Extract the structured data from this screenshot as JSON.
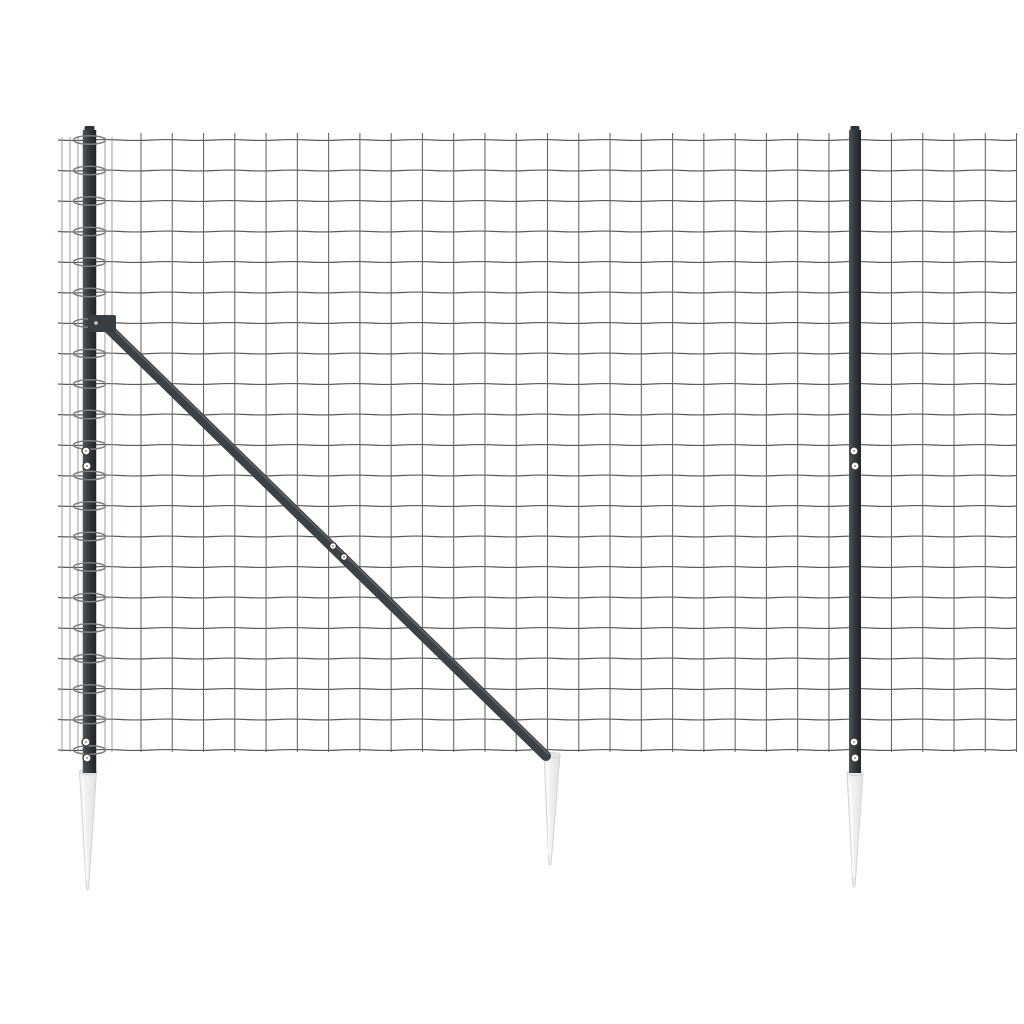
{
  "scene": {
    "description": "anthracite wire mesh fence panel with two posts, diagonal brace strut and three ground anchor spikes on white background",
    "background": "#ffffff",
    "width": 1024,
    "height": 1024,
    "colors": {
      "wire": "#565a5c",
      "wire_vertical": "#616466",
      "wire_edge": "#8f9294",
      "ring": "#7a7e80",
      "post_grad": [
        "#51575b",
        "#3a3f43",
        "#2c3134",
        "#202427"
      ],
      "post_cap": "#2e3236",
      "brace": "#3c4145",
      "brace_highlight": "#71777d",
      "clamp": "#393e42",
      "screw_fill": "#ffffff",
      "screw_ring": "#3a3a3a",
      "screw_dot": "#6a6a6a",
      "spike_grad": [
        "#f7f7f8",
        "#efeff1",
        "#dfe0e2"
      ],
      "spike_edge": "#d2d3d5",
      "spike_rim": "#e4e5e7"
    },
    "mesh": {
      "x_left": 58,
      "x_right": 1016,
      "wire_top": 133,
      "wire_bottom": 752,
      "row_top": 140,
      "row_step": 30.5,
      "row_count": 21,
      "wave_amplitude": 0.9,
      "verticals_extra": [
        62,
        70,
        78,
        105,
        112
      ],
      "verticals_start": 141,
      "verticals_step": 31.27,
      "verticals_count": 29
    },
    "posts": [
      {
        "name": "left-fence-post",
        "cx": 89.5,
        "top": 130,
        "bottom": 773,
        "width": 13.5,
        "cap": {
          "x": 84.5,
          "y": 126,
          "w": 10,
          "h": 7
        },
        "has_rings": true,
        "ring_rx": 16,
        "ring_ry": 4.2,
        "screws": [
          [
            86,
            451
          ],
          [
            87,
            466
          ],
          [
            86,
            742
          ],
          [
            87,
            758
          ]
        ]
      },
      {
        "name": "right-fence-post",
        "cx": 855,
        "top": 130,
        "bottom": 773,
        "width": 12,
        "cap": {
          "x": 850.5,
          "y": 126,
          "w": 9,
          "h": 7
        },
        "has_rings": false,
        "ring_rx": 0,
        "ring_ry": 0,
        "screws": [
          [
            854,
            451
          ],
          [
            855,
            466
          ],
          [
            854,
            742
          ],
          [
            855,
            758
          ]
        ]
      }
    ],
    "brace": {
      "name": "diagonal-brace-strut",
      "x1": 104,
      "y1": 324,
      "x2": 546,
      "y2": 756,
      "width": 10,
      "clamp": {
        "x": 88,
        "y": 315,
        "w": 28,
        "h": 17,
        "bolt_x": 96,
        "bolt_y": 323
      },
      "screws": [
        [
          333,
          546
        ],
        [
          344,
          557
        ]
      ]
    },
    "spikes": [
      {
        "name": "left-ground-spike",
        "top_y": 772,
        "left_x": 79.5,
        "right_x": 96.5,
        "tip_x": 87.5,
        "tip_y": 893,
        "rim_cx": 88,
        "rim_rx": 8.5,
        "rim_ry": 2.8
      },
      {
        "name": "middle-ground-spike",
        "top_y": 755,
        "left_x": 544,
        "right_x": 560,
        "tip_x": 550,
        "tip_y": 868,
        "rim_cx": 552,
        "rim_rx": 8,
        "rim_ry": 2.6
      },
      {
        "name": "right-ground-spike",
        "top_y": 773,
        "left_x": 847,
        "right_x": 863,
        "tip_x": 854,
        "tip_y": 890,
        "rim_cx": 855,
        "rim_rx": 8,
        "rim_ry": 2.6
      }
    ]
  }
}
